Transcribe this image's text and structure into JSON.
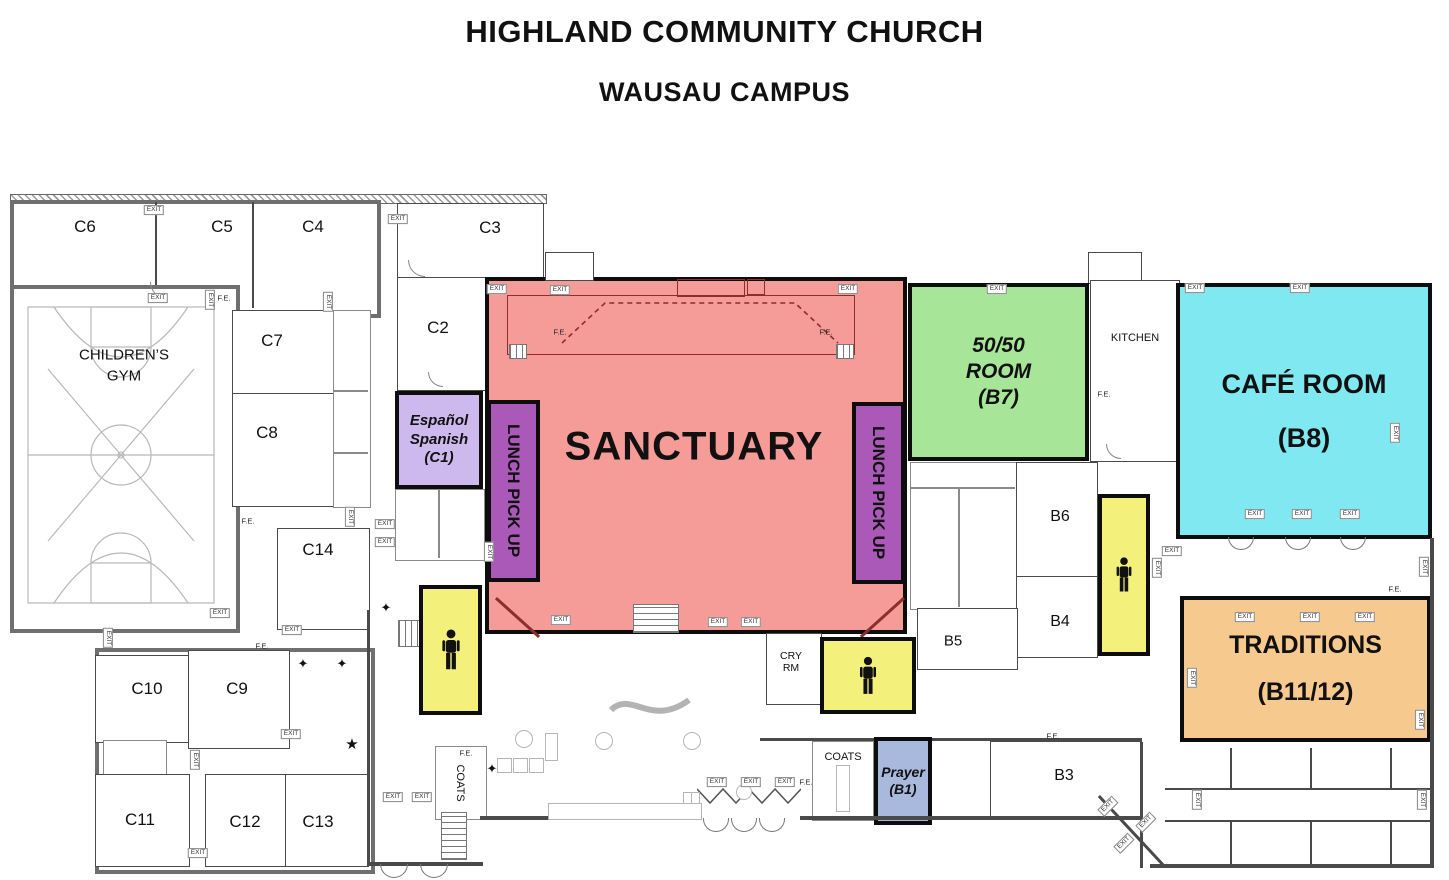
{
  "title": {
    "line1": "HIGHLAND COMMUNITY CHURCH",
    "line2": "WAUSAU CAMPUS"
  },
  "legend_labels": {
    "exit": "EXIT",
    "fire_extinguisher": "F.E."
  },
  "symbols": {
    "sparkle": "✦",
    "star": "★"
  },
  "colors": {
    "sanctuary": "#f59b98",
    "lunch_pickup": "#ab59b8",
    "espanol": "#cdb9ee",
    "fifty_fifty_room": "#a7e699",
    "cafe_room": "#7fe8f1",
    "traditions": "#f6c98e",
    "prayer": "#a9b9de",
    "restroom": "#f3f17b",
    "wall_outline": "#111111"
  },
  "rooms": {
    "sanctuary": {
      "name": "SANCTUARY"
    },
    "lunch_pickup": {
      "name": "LUNCH PICK UP"
    },
    "espanol": {
      "line1": "Español",
      "line2": "Spanish",
      "line3": "(C1)"
    },
    "fifty_fifty": {
      "line1": "50/50",
      "line2": "ROOM",
      "line3": "(B7)"
    },
    "cafe": {
      "line1": "CAFÉ ROOM",
      "line2": "(B8)"
    },
    "traditions": {
      "line1": "TRADITIONS",
      "line2": "(B11/12)"
    },
    "prayer": {
      "line1": "Prayer",
      "line2": "(B1)"
    },
    "children_gym": {
      "line1": "CHILDREN’S",
      "line2": "GYM"
    },
    "kitchen": "KITCHEN",
    "cry_room": {
      "line1": "CRY",
      "line2": "RM"
    },
    "coats_lobby": "COATS",
    "coats_entry": "COATS",
    "c2": "C2",
    "c3": "C3",
    "c4": "C4",
    "c5": "C5",
    "c6": "C6",
    "c7": "C7",
    "c8": "C8",
    "c9": "C9",
    "c10": "C10",
    "c11": "C11",
    "c12": "C12",
    "c13": "C13",
    "c14": "C14",
    "b3": "B3",
    "b4": "B4",
    "b5": "B5",
    "b6": "B6"
  }
}
